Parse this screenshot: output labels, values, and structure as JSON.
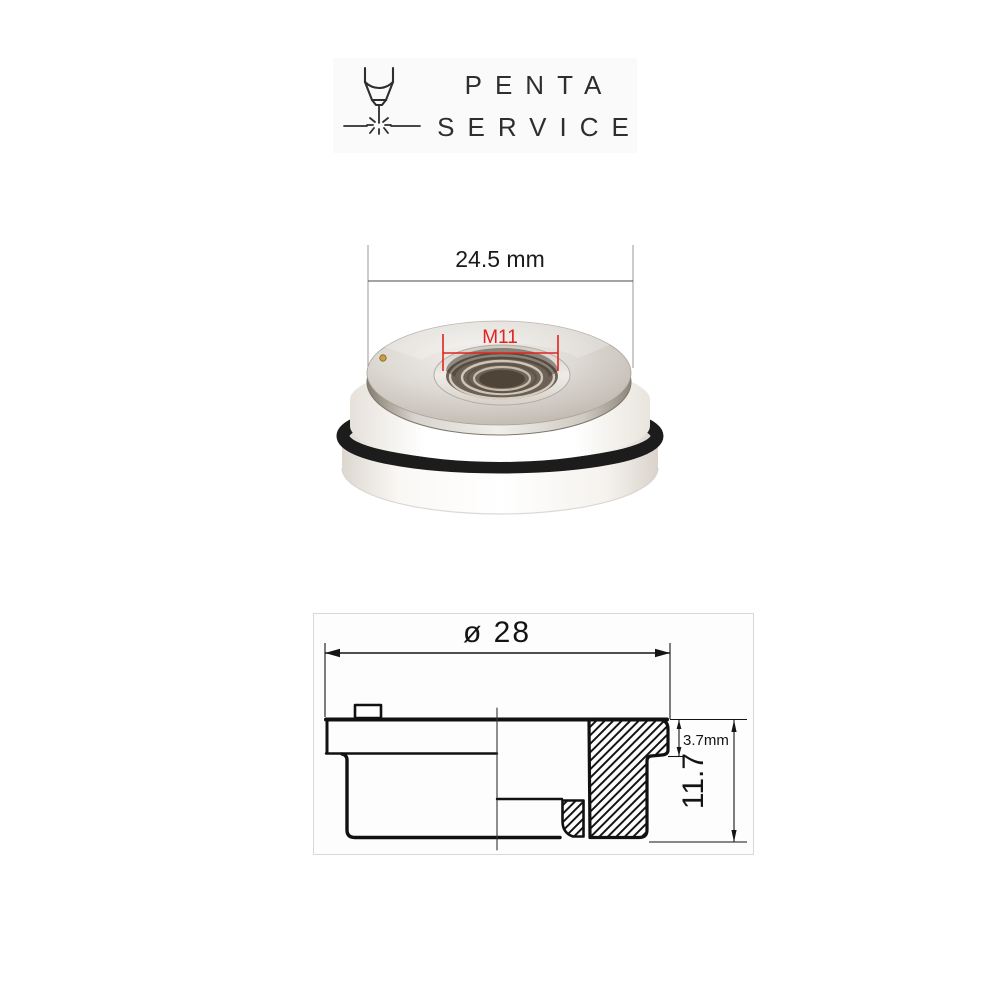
{
  "brand": {
    "line1": "PENTA",
    "line2": "SERVICE",
    "icon": "laser-cutting-head-icon",
    "text_color": "#2e2e2e",
    "panel_bg": "#fafafa"
  },
  "photo": {
    "outer_diameter_label": "24.5 mm",
    "thread_label": "M11",
    "annotation_color": "#e02420",
    "part": {
      "top": "polished metal ring with threaded bore",
      "body": "white ceramic ring",
      "seal": "black o-ring"
    }
  },
  "drawing": {
    "diameter_label": "ø 28",
    "flange_height_label": "3.7mm",
    "total_height_label": "11.7",
    "line_color": "#141414",
    "frame_color": "#d8d8d8"
  }
}
